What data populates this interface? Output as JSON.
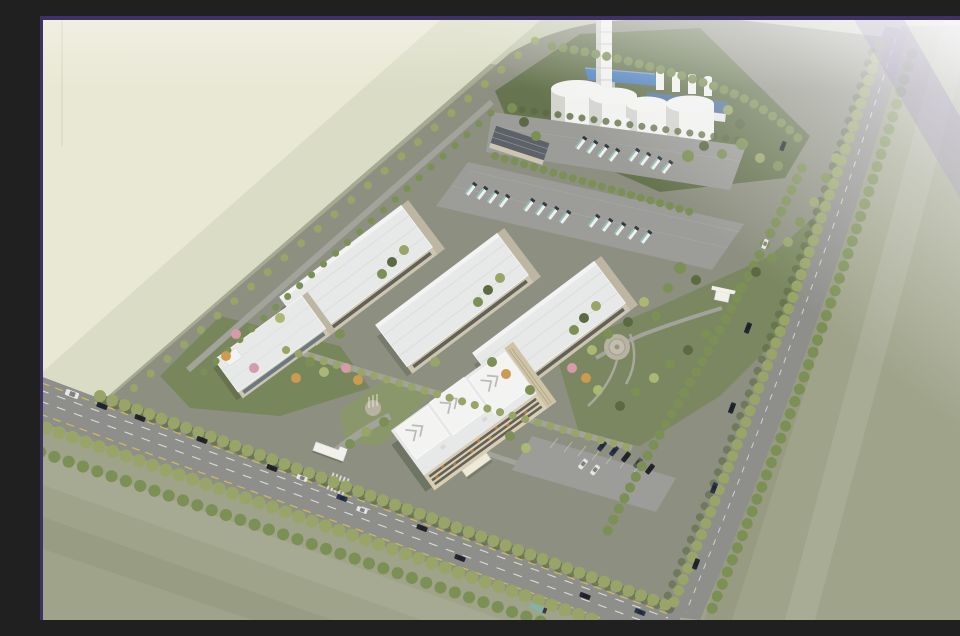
{
  "scene": {
    "title": "Aerial 3D architectural rendering of a walled industrial plant campus surrounded by farmland and tree-lined roads",
    "view": "oblique bird's-eye perspective, haze toward the top-right horizon",
    "objects": {
      "chimney": "tall white exhaust stack, cut off by the top frame",
      "storage_tanks": {
        "label": "large white dome-top storage tanks",
        "count": 4
      },
      "roof_silos": {
        "label": "small white silos on the process building",
        "count": 4
      },
      "small_tanks": {
        "label": "small ground tanks beside the large tanks",
        "count": 3
      },
      "process_buildings": "blue pitched-roof process hall and blue-banded utility building",
      "warehouses": {
        "label": "parallel flat-roof warehouse halls with beige walls",
        "count": 3
      },
      "loading_building": "long slate-roofed loading building at the truck lot",
      "office_building": "five-storey cream office block with stepped white roof and entrance canopy",
      "annex_building": "two-storey white-roofed annex office",
      "truck_lots": {
        "label": "paved lots with rows of white tanker trucks",
        "truck_count": 21
      },
      "car_park": {
        "label": "staff car park beside the office",
        "car_count": 7
      },
      "south_gate": "main entrance gate with white canopy and crosswalk",
      "east_gate": "secondary gate house on the east avenue",
      "plaza": "circular paved plaza in the east garden",
      "flag_plaza": "small forecourt with flag poles in front of the office",
      "roads": "wide boulevard along the south-west edge and tree-lined avenue along the east edge, both with traffic",
      "road_vehicles": {
        "count": 18
      },
      "fields": "pale and sage farm fields with diagonal strip patterns",
      "gardens": "landscaped gardens with green, pink and orange trees",
      "frame": "dark purple border on the top, left and right edges",
      "edge_notch": "small white semicircular notch on the right edge"
    }
  },
  "colors": {
    "border_purple": "#3e3166",
    "field_pale": "#e9e8d5",
    "field_pale_band": "#dbdcc5",
    "field_pale_band2": "#cfd1ba",
    "field_top_light": "#c6cbb2",
    "field_top_green": "#a5b48e",
    "field_sage": "#a6aa92",
    "field_sage_dark": "#9fa389",
    "road_grey": "#8e8e8a",
    "lane_white": "#e8e8e4",
    "lane_yellow": "#d2c054",
    "site_ground": "#8d9080",
    "lot_grey": "#9c9c98",
    "plant_green": "#66744f",
    "lawn_green": "#78865c",
    "lawn_light": "#8a976a",
    "path_grey": "#a2a39a",
    "roof_white": "#e7e9e8",
    "roof_bright": "#f3f4f2",
    "wall_beige": "#cbc5b1",
    "wall_dark": "#bdb6a2",
    "window_dark": "#58554e",
    "facade_cream": "#d8ceb3",
    "facade_shade": "#cec3a5",
    "accent_orange": "#b07a40",
    "blue_roof": "#4f82bd",
    "blue_roof2": "#56789e",
    "slate_roof": "#5d6268",
    "tank_white": "#f2f2ef",
    "tank_shade": "#d4d4cf",
    "chimney_white": "#f1f1ee",
    "gate_white": "#f1f0ea",
    "plaza_tan": "#b7b2a2",
    "tree_olive": "#98a468",
    "tree_green": "#7c8f55",
    "tree_dark": "#5c6a44",
    "tree_light": "#aab873",
    "tree_pink": "#d49cab",
    "tree_orange": "#cd9a51",
    "car_dark": "#23262c",
    "car_white": "#e6e7e4",
    "car_grey": "#595b60",
    "car_navy": "#2c3550",
    "truck_white": "#edf1ee",
    "truck_teal": "#84b1aa",
    "truck_dark": "#343a40",
    "haze_white": "#f7f6fa",
    "haze_lavender": "#b3a8cc",
    "notch_white": "#fdfdfd"
  }
}
